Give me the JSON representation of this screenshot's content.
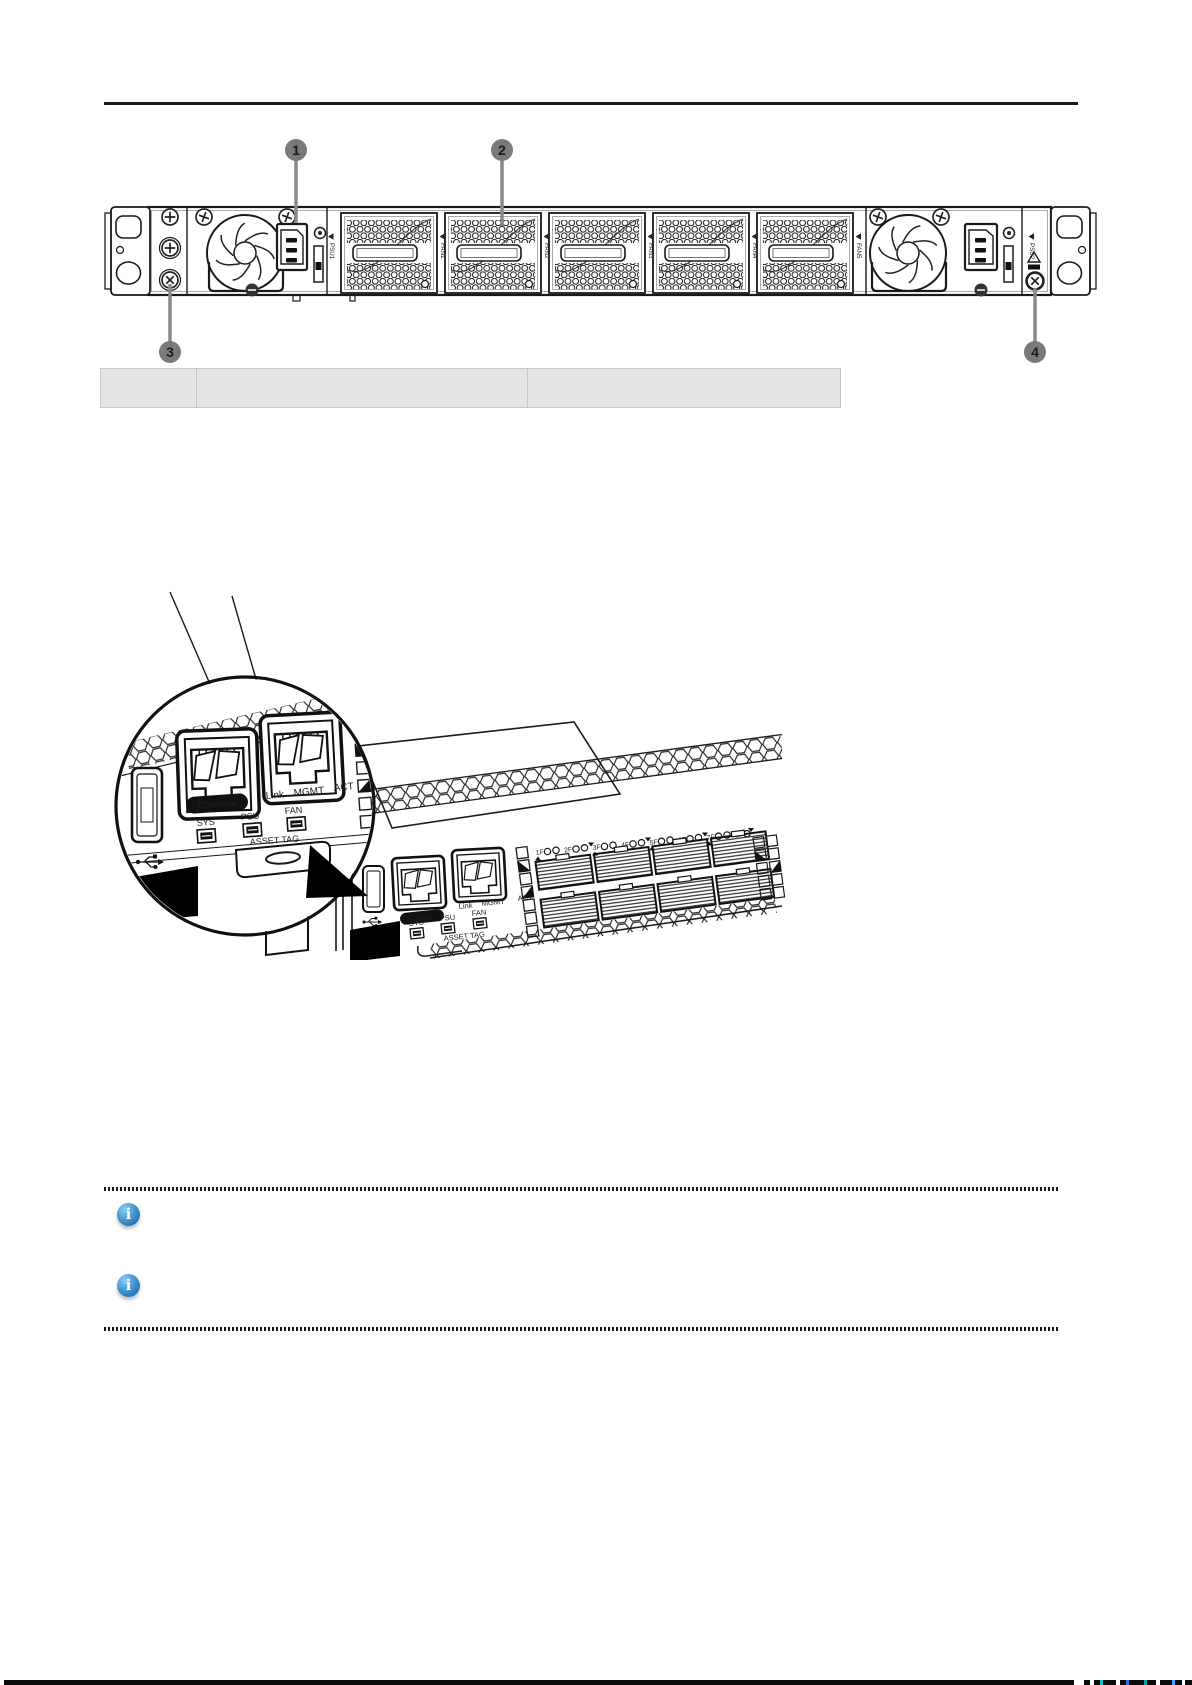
{
  "figure1": {
    "callout1": "1",
    "callout2": "2",
    "callout3": "3",
    "callout4": "4",
    "psu1": "PSU1",
    "psu2": "PSU2",
    "fans": [
      "FAN1",
      "FAN2",
      "FAN3",
      "FAN4",
      "FAN5"
    ]
  },
  "parts_table": {
    "col1": "",
    "col2": "",
    "col3": ""
  },
  "figure2": {
    "magnifier": {
      "console": "Console",
      "link": "Link",
      "mgmt": "MGMT",
      "act": "ACT",
      "sys": "SYS",
      "psu": "PSU",
      "fan": "FAN",
      "asset_tag": "ASSET TAG"
    },
    "device": {
      "console": "Console",
      "link": "Link",
      "mgmt": "MGMT",
      "act": "ACT",
      "sys": "SYS",
      "psu": "PSU",
      "fan": "FAN",
      "asset_tag": "ASSET TAG",
      "ports": [
        "1F",
        "2F",
        "3F",
        "4F",
        "5F",
        "6F",
        "7F",
        "8F"
      ]
    }
  },
  "notes": {
    "icon_glyph": "i",
    "note1": "",
    "note2": ""
  },
  "colors": {
    "callout_gray": "#7a7a7a",
    "table_bg": "#e4e4e4",
    "info_blue": "#2e7cbe",
    "line_black": "#1a1a1a"
  }
}
